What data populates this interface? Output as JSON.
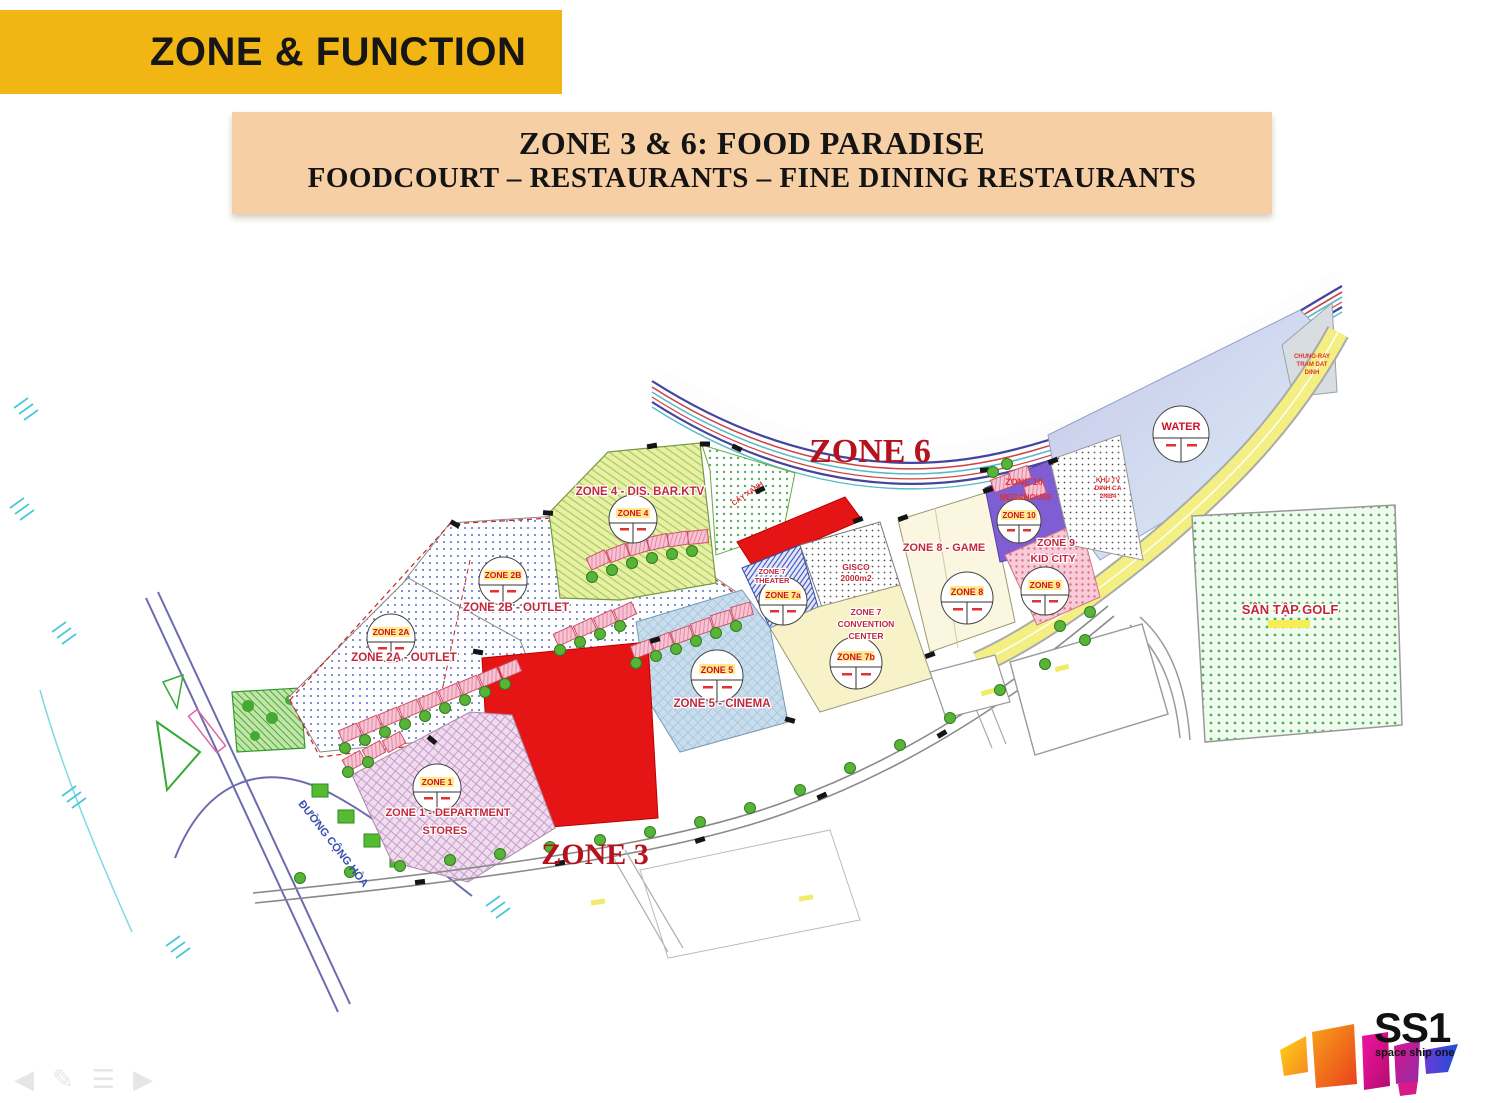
{
  "header": {
    "title": "ZONE & FUNCTION"
  },
  "banner": {
    "line1": "ZONE 3 & 6: FOOD PARADISE",
    "line2": "FOODCOURT – RESTAURANTS – FINE DINING RESTAURANTS"
  },
  "map": {
    "zone6_label": "ZONE 6",
    "zone3_label": "ZONE 3",
    "labels": {
      "zone4": "ZONE 4 - DIS. BAR.KTV",
      "zone2b": "ZONE 2B - OUTLET",
      "zone2a": "ZONE 2A - OUTLET",
      "zone1_line1": "ZONE 1 - DEPARTMENT",
      "zone1_line2": "STORES",
      "zone5": "ZONE 5 - CINEMA",
      "zone7a_line1": "ZONE 7",
      "zone7a_line2": "THEATER",
      "gisco_line1": "GISCO",
      "gisco_line2": "2000m2",
      "zone7b_line1": "ZONE 7",
      "zone7b_line2": "CONVENTION",
      "zone7b_line3": "CENTER",
      "zone8": "ZONE 8 - GAME",
      "zone10_line1": "ZONE 10",
      "zone10_line2": "MEGAHOUSE",
      "zone9_line1": "ZONE 9",
      "zone9_line2": "KID CITY",
      "golf": "SÂN TẬP GOLF",
      "resettle_line1": "KHU TV",
      "resettle_line2": "DINH CA",
      "resettle_line3": "2NB4",
      "corner_line1": "CHUNG-RAY",
      "corner_line2": "TRAM DAT",
      "corner_line3": "DINH",
      "greenery": "CÂY XANH",
      "road": "ĐƯỜNG CỘNG HÒA"
    },
    "stamps": {
      "z2b": "ZONE 2B",
      "z2a": "ZONE 2A",
      "z1": "ZONE 1",
      "z4": "ZONE 4",
      "z5": "ZONE 5",
      "z7a": "ZONE 7a",
      "z7b": "ZONE 7b",
      "z8": "ZONE 8",
      "z9": "ZONE 9",
      "z10": "ZONE 10",
      "water": "WATER"
    },
    "colors": {
      "header_bg": "#F2B614",
      "banner_bg": "#F6CFA4",
      "parcel_red": "#E51515",
      "label_red": "#C2273A",
      "zone10_purple": "#7E5ED2",
      "road_yellow": "#F3EF82"
    }
  },
  "logo": {
    "text": "SS1",
    "tagline": "space ship one"
  },
  "controls": {
    "prev": "◀",
    "pen": "✎",
    "menu": "☰",
    "next": "▶"
  }
}
